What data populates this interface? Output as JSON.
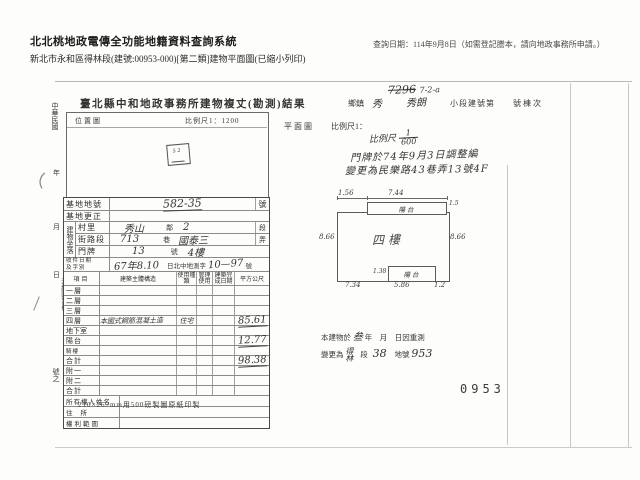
{
  "header": {
    "system_title": "北北桃地政電傳全功能地籍資料查詢系統",
    "query_date": "查詢日期：114年9月8日（如需登記謄本，請向地政事務所申請。）",
    "doc_line": "新北市永和區得林段(建號:00953-000)[第二類]建物平面圖(已縮小列印)"
  },
  "scan": {
    "title": "臺北縣中和地政事務所建物複丈(勘測)結果",
    "corner": {
      "struck_number": "7296",
      "annotation": "7-2-a"
    },
    "admin_row": {
      "township_label": "鄉鎮",
      "township_value": "秀",
      "section_value": "秀朗",
      "subsection_label": "小段建號第",
      "suffix_label": "號棟次"
    },
    "location_map": {
      "label": "位置圖",
      "scale": "比例尺1：1200",
      "parcel_mark": "5 2"
    },
    "margin": {
      "items": [
        "中華民國",
        "年",
        "月",
        "日",
        "測繪圖簿冊",
        "號之"
      ]
    },
    "plan": {
      "label": "平面圖",
      "scale_label": "比例尺1：",
      "hand_scale_prefix": "比例尺",
      "hand_scale_num": "1",
      "hand_scale_den": "600",
      "note1": "門牌於74年9月3日調整編",
      "note2": "變更為民樂路43巷弄13號4F",
      "drawing": {
        "dim_top_left": "1.56",
        "dim_top": "7.44",
        "dim_top_right": "1.5",
        "balcony_top": "陽台",
        "dim_left": "8.66",
        "dim_right": "8.66",
        "floor_label": "四樓",
        "balcony_bottom": "陽台",
        "dim_balcony_bottom_left": "1.38",
        "dim_bottom_left": "7.34",
        "dim_bottom_mid": "5.86",
        "dim_bottom_right": "1.2"
      },
      "base_note": {
        "prefix": "本建物於",
        "hand_year": "叁",
        "mid": "年　月　日因重測",
        "line2_prefix": "變更為",
        "hand_section": "得林",
        "seg_label": "段",
        "hand_no": "38",
        "parcel_label": "地號",
        "hand_parcel": "953"
      },
      "stamp_number": "0953"
    },
    "table": {
      "base_parcel": {
        "label": "基地地號",
        "value": "582-35",
        "suffix": "號"
      },
      "base_fix": {
        "label": "基地更正"
      },
      "situs_group": "建物坐落",
      "situs_rows": [
        {
          "label": "村里",
          "v1": "秀山",
          "mid": "鄰",
          "v2": "2",
          "right": "段"
        },
        {
          "label": "街路段",
          "v1": "713",
          "mid": "巷",
          "v2": "國泰三",
          "right": "弄"
        },
        {
          "label": "門牌",
          "v1": "13",
          "mid": "號",
          "v2": "4樓",
          "right": ""
        }
      ],
      "receipt": {
        "label1": "收件日期",
        "label2": "及字別",
        "hand1": "67年8.10",
        "printed": "日北中地測字",
        "hand2": "10—97",
        "suffix": "號"
      },
      "head": {
        "c1": "項目",
        "c2": "建築主體構造",
        "c3": "使用種類",
        "c4": "管理使用",
        "c5": "建築完成日期",
        "c6": "平方公尺"
      },
      "floors": [
        {
          "label": "一層",
          "structure": "",
          "use": "",
          "area": ""
        },
        {
          "label": "二層",
          "structure": "",
          "use": "",
          "area": ""
        },
        {
          "label": "三層",
          "structure": "",
          "use": "",
          "area": ""
        },
        {
          "label": "四層",
          "structure": "本國式鋼筋混凝土造",
          "use": "住宅",
          "area": "85.61"
        },
        {
          "label": "地下室",
          "structure": "",
          "use": "",
          "area": ""
        },
        {
          "label": "陽台",
          "structure": "",
          "use": "",
          "area": "12.77"
        },
        {
          "label": "騎樓",
          "structure": "",
          "use": "",
          "area": ""
        },
        {
          "label": "合計",
          "structure": "",
          "use": "",
          "area": "98.38"
        },
        {
          "label": "附一",
          "structure": "",
          "use": "",
          "area": ""
        },
        {
          "label": "附二",
          "structure": "",
          "use": "",
          "area": ""
        },
        {
          "label": "合計",
          "structure": "",
          "use": "",
          "area": ""
        }
      ],
      "owner_rows": [
        {
          "label": "所有權人姓名"
        },
        {
          "label": "住所"
        },
        {
          "label": "權利範圍"
        }
      ]
    },
    "footer_note": "210×267mm用500磅製圖原紙印製"
  }
}
